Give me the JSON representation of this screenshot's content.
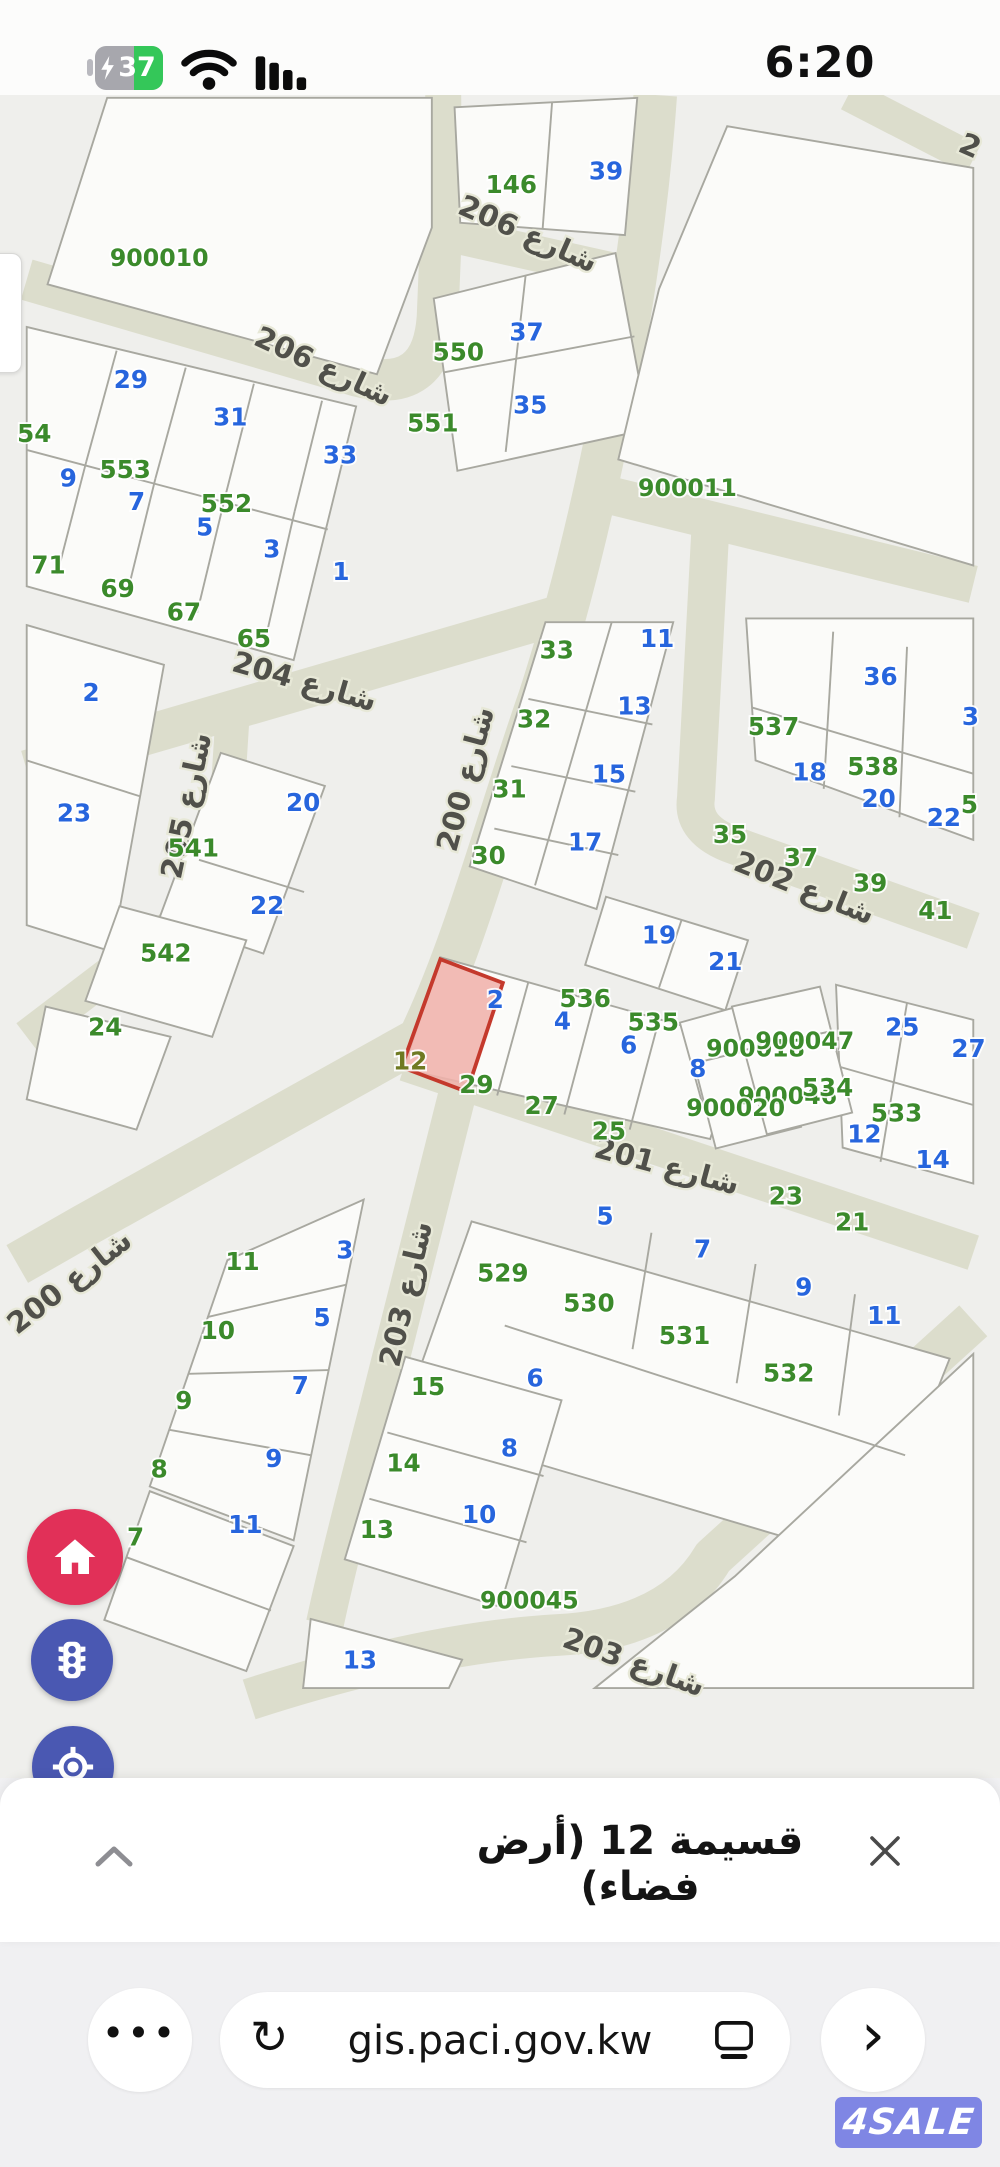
{
  "status_bar": {
    "time": "6:20",
    "battery_percent": "37",
    "battery_charging": true,
    "battery_color": "#34c759",
    "icons": [
      "battery-charging-icon",
      "wifi-icon",
      "cellular-bars-icon"
    ]
  },
  "map": {
    "selected_parcel": {
      "number": "12",
      "fill": "#f0b2ab",
      "stroke": "#c4392c"
    },
    "colors": {
      "background": "#efefec",
      "road": "#dcddcc",
      "parcel_fill": "#fbfbf9",
      "parcel_stroke": "#a8a8a0",
      "parcel_number_blue": "#2765dd",
      "block_number_green": "#3b8a2b",
      "street_label_text": "#50504a"
    },
    "streets": [
      {
        "t": "شارع 206",
        "x": 529,
        "y": 243,
        "r": 24
      },
      {
        "t": "شارع 206",
        "x": 313,
        "y": 383,
        "r": 25
      },
      {
        "t": "شارع 204",
        "x": 293,
        "y": 716,
        "r": 16
      },
      {
        "t": "شارع 205",
        "x": 170,
        "y": 846,
        "r": -78
      },
      {
        "t": "شارع 200",
        "x": 465,
        "y": 818,
        "r": -75
      },
      {
        "t": "شارع 202",
        "x": 821,
        "y": 934,
        "r": 22
      },
      {
        "t": "شارع 201",
        "x": 676,
        "y": 1228,
        "r": 15
      },
      {
        "t": "شارع 200",
        "x": 46,
        "y": 1350,
        "r": -38
      },
      {
        "t": "شارع 203",
        "x": 402,
        "y": 1362,
        "r": -77
      },
      {
        "t": "شارع 203",
        "x": 641,
        "y": 1752,
        "r": 20
      },
      {
        "t": "2",
        "x": 996,
        "y": 150,
        "r": 24
      }
    ],
    "numbers": [
      {
        "t": "39",
        "x": 612,
        "y": 177,
        "c": "b"
      },
      {
        "t": "146",
        "x": 512,
        "y": 191,
        "c": "g"
      },
      {
        "t": "900010",
        "x": 140,
        "y": 269,
        "c": "g"
      },
      {
        "t": "550",
        "x": 456,
        "y": 368,
        "c": "g"
      },
      {
        "t": "37",
        "x": 528,
        "y": 347,
        "c": "b"
      },
      {
        "t": "551",
        "x": 429,
        "y": 443,
        "c": "g"
      },
      {
        "t": "35",
        "x": 532,
        "y": 424,
        "c": "b"
      },
      {
        "t": "900011",
        "x": 698,
        "y": 512,
        "c": "g"
      },
      {
        "t": "29",
        "x": 110,
        "y": 397,
        "c": "b"
      },
      {
        "t": "31",
        "x": 215,
        "y": 437,
        "c": "b"
      },
      {
        "t": "33",
        "x": 331,
        "y": 477,
        "c": "b"
      },
      {
        "t": "54",
        "x": 8,
        "y": 454,
        "c": "g"
      },
      {
        "t": "553",
        "x": 104,
        "y": 492,
        "c": "g"
      },
      {
        "t": "552",
        "x": 211,
        "y": 528,
        "c": "g"
      },
      {
        "t": "9",
        "x": 44,
        "y": 501,
        "c": "b"
      },
      {
        "t": "7",
        "x": 116,
        "y": 526,
        "c": "b"
      },
      {
        "t": "5",
        "x": 188,
        "y": 553,
        "c": "b"
      },
      {
        "t": "3",
        "x": 259,
        "y": 576,
        "c": "b"
      },
      {
        "t": "1",
        "x": 332,
        "y": 600,
        "c": "b"
      },
      {
        "t": "71",
        "x": 23,
        "y": 593,
        "c": "g"
      },
      {
        "t": "69",
        "x": 96,
        "y": 618,
        "c": "g"
      },
      {
        "t": "67",
        "x": 166,
        "y": 643,
        "c": "g"
      },
      {
        "t": "65",
        "x": 240,
        "y": 671,
        "c": "g"
      },
      {
        "t": "2",
        "x": 68,
        "y": 728,
        "c": "b"
      },
      {
        "t": "23",
        "x": 50,
        "y": 855,
        "c": "b"
      },
      {
        "t": "20",
        "x": 292,
        "y": 844,
        "c": "b"
      },
      {
        "t": "22",
        "x": 254,
        "y": 953,
        "c": "b"
      },
      {
        "t": "541",
        "x": 176,
        "y": 892,
        "c": "g"
      },
      {
        "t": "542",
        "x": 147,
        "y": 1003,
        "c": "g"
      },
      {
        "t": "24",
        "x": 83,
        "y": 1081,
        "c": "g"
      },
      {
        "t": "33",
        "x": 560,
        "y": 683,
        "c": "g"
      },
      {
        "t": "11",
        "x": 666,
        "y": 671,
        "c": "b"
      },
      {
        "t": "32",
        "x": 536,
        "y": 756,
        "c": "g"
      },
      {
        "t": "13",
        "x": 642,
        "y": 742,
        "c": "b"
      },
      {
        "t": "31",
        "x": 510,
        "y": 830,
        "c": "g"
      },
      {
        "t": "15",
        "x": 615,
        "y": 814,
        "c": "b"
      },
      {
        "t": "30",
        "x": 488,
        "y": 900,
        "c": "g"
      },
      {
        "t": "17",
        "x": 590,
        "y": 886,
        "c": "b"
      },
      {
        "t": "537",
        "x": 789,
        "y": 764,
        "c": "g"
      },
      {
        "t": "36",
        "x": 902,
        "y": 711,
        "c": "b"
      },
      {
        "t": "538",
        "x": 894,
        "y": 806,
        "c": "g"
      },
      {
        "t": "18",
        "x": 827,
        "y": 812,
        "c": "b"
      },
      {
        "t": "20",
        "x": 900,
        "y": 840,
        "c": "b"
      },
      {
        "t": "22",
        "x": 969,
        "y": 860,
        "c": "b"
      },
      {
        "t": "3",
        "x": 997,
        "y": 753,
        "c": "b"
      },
      {
        "t": "5",
        "x": 996,
        "y": 846,
        "c": "g"
      },
      {
        "t": "35",
        "x": 743,
        "y": 878,
        "c": "g"
      },
      {
        "t": "37",
        "x": 818,
        "y": 902,
        "c": "g"
      },
      {
        "t": "39",
        "x": 891,
        "y": 929,
        "c": "g"
      },
      {
        "t": "41",
        "x": 960,
        "y": 958,
        "c": "g"
      },
      {
        "t": "19",
        "x": 668,
        "y": 984,
        "c": "b"
      },
      {
        "t": "21",
        "x": 738,
        "y": 1012,
        "c": "b"
      },
      {
        "t": "2",
        "x": 495,
        "y": 1052,
        "c": "b"
      },
      {
        "t": "536",
        "x": 590,
        "y": 1051,
        "c": "g"
      },
      {
        "t": "4",
        "x": 566,
        "y": 1075,
        "c": "b"
      },
      {
        "t": "535",
        "x": 662,
        "y": 1076,
        "c": "g"
      },
      {
        "t": "6",
        "x": 636,
        "y": 1100,
        "c": "b"
      },
      {
        "t": "8",
        "x": 709,
        "y": 1125,
        "c": "b"
      },
      {
        "t": "12",
        "x": 405,
        "y": 1117,
        "c": "o"
      },
      {
        "t": "29",
        "x": 475,
        "y": 1142,
        "c": "g"
      },
      {
        "t": "27",
        "x": 544,
        "y": 1164,
        "c": "g"
      },
      {
        "t": "25",
        "x": 615,
        "y": 1191,
        "c": "g"
      },
      {
        "t": "900018",
        "x": 770,
        "y": 1104,
        "c": "g"
      },
      {
        "t": "900047",
        "x": 822,
        "y": 1096,
        "c": "g"
      },
      {
        "t": "900046",
        "x": 804,
        "y": 1154,
        "c": "g"
      },
      {
        "t": "534",
        "x": 846,
        "y": 1145,
        "c": "g"
      },
      {
        "t": "900020",
        "x": 749,
        "y": 1167,
        "c": "g"
      },
      {
        "t": "533",
        "x": 919,
        "y": 1172,
        "c": "g"
      },
      {
        "t": "25",
        "x": 925,
        "y": 1081,
        "c": "b"
      },
      {
        "t": "27",
        "x": 995,
        "y": 1104,
        "c": "b"
      },
      {
        "t": "12",
        "x": 885,
        "y": 1194,
        "c": "b"
      },
      {
        "t": "14",
        "x": 957,
        "y": 1221,
        "c": "b"
      },
      {
        "t": "23",
        "x": 802,
        "y": 1260,
        "c": "g"
      },
      {
        "t": "21",
        "x": 872,
        "y": 1287,
        "c": "g"
      },
      {
        "t": "5",
        "x": 611,
        "y": 1281,
        "c": "b"
      },
      {
        "t": "7",
        "x": 714,
        "y": 1316,
        "c": "b"
      },
      {
        "t": "9",
        "x": 821,
        "y": 1356,
        "c": "b"
      },
      {
        "t": "11",
        "x": 906,
        "y": 1386,
        "c": "b"
      },
      {
        "t": "529",
        "x": 503,
        "y": 1341,
        "c": "g"
      },
      {
        "t": "530",
        "x": 594,
        "y": 1373,
        "c": "g"
      },
      {
        "t": "531",
        "x": 695,
        "y": 1407,
        "c": "g"
      },
      {
        "t": "532",
        "x": 805,
        "y": 1447,
        "c": "g"
      },
      {
        "t": "11",
        "x": 228,
        "y": 1329,
        "c": "g"
      },
      {
        "t": "3",
        "x": 336,
        "y": 1317,
        "c": "b"
      },
      {
        "t": "10",
        "x": 202,
        "y": 1402,
        "c": "g"
      },
      {
        "t": "5",
        "x": 312,
        "y": 1388,
        "c": "b"
      },
      {
        "t": "9",
        "x": 166,
        "y": 1476,
        "c": "g"
      },
      {
        "t": "7",
        "x": 289,
        "y": 1460,
        "c": "b"
      },
      {
        "t": "8",
        "x": 140,
        "y": 1548,
        "c": "g"
      },
      {
        "t": "9",
        "x": 261,
        "y": 1537,
        "c": "b"
      },
      {
        "t": "15",
        "x": 424,
        "y": 1461,
        "c": "g"
      },
      {
        "t": "6",
        "x": 537,
        "y": 1452,
        "c": "b"
      },
      {
        "t": "14",
        "x": 398,
        "y": 1542,
        "c": "g"
      },
      {
        "t": "8",
        "x": 510,
        "y": 1526,
        "c": "b"
      },
      {
        "t": "13",
        "x": 370,
        "y": 1612,
        "c": "g"
      },
      {
        "t": "10",
        "x": 478,
        "y": 1596,
        "c": "b"
      },
      {
        "t": "7",
        "x": 115,
        "y": 1620,
        "c": "g"
      },
      {
        "t": "11",
        "x": 231,
        "y": 1607,
        "c": "b"
      },
      {
        "t": "900045",
        "x": 531,
        "y": 1687,
        "c": "g"
      },
      {
        "t": "13",
        "x": 352,
        "y": 1750,
        "c": "b"
      }
    ]
  },
  "map_buttons": {
    "home": {
      "icon": "home-icon",
      "color": "#e13058"
    },
    "traffic": {
      "icon": "traffic-light-icon",
      "color": "#4a58b2"
    },
    "locate": {
      "icon": "locate-icon",
      "color": "#4a58b2"
    }
  },
  "bottom_sheet": {
    "title": "قسيمة 12 (أرض فضاء)",
    "collapse_icon": "chevron-up",
    "close_icon": "x"
  },
  "browser_bar": {
    "menu_icon": "•••",
    "reload_icon": "↻",
    "url": "gis.paci.gov.kw",
    "reader_icon": "tab-window",
    "forward_icon": "›"
  },
  "watermark": {
    "text": "4SALE",
    "bg_color": "#7f86e4"
  }
}
